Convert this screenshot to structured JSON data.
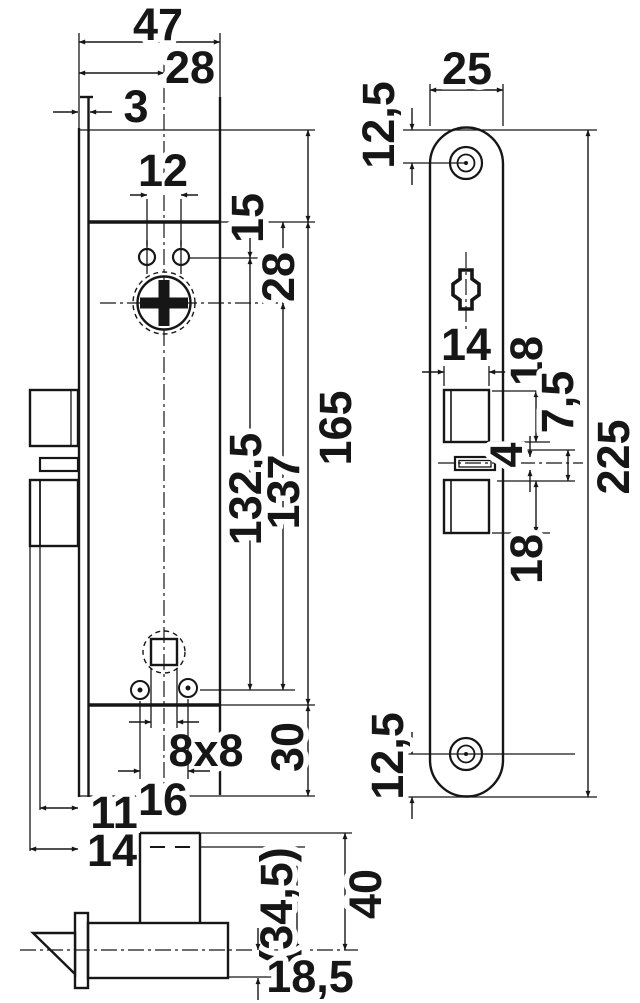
{
  "dims": {
    "side": {
      "case_depth": "47",
      "backset": "28",
      "faceplate_thickness": "3",
      "hole_spacing": "12",
      "holes_to_spindle": "15",
      "case_top_to_spindle": "28",
      "case_height": "165",
      "spindle_to_fixing_holes": "132,5",
      "spindle_to_case_bottom": "137",
      "case_to_plate_end": "30",
      "follower_square": "8x8",
      "fixing_hole_spacing": "16",
      "aux_bolt_throw": "11",
      "bolt_throw": "14"
    },
    "bottom": {
      "inner_width": "(34,5)",
      "outer_width": "40",
      "latch_height": "18,5"
    },
    "plate": {
      "width": "25",
      "end_to_screw_top": "12,5",
      "latch_cutout_width": "14",
      "latch_cutout_height": "18",
      "aux_offset": "7,5",
      "slot_height": "4",
      "bolt_cutout_height": "18",
      "end_to_screw_bottom": "12,5",
      "length": "225"
    }
  }
}
